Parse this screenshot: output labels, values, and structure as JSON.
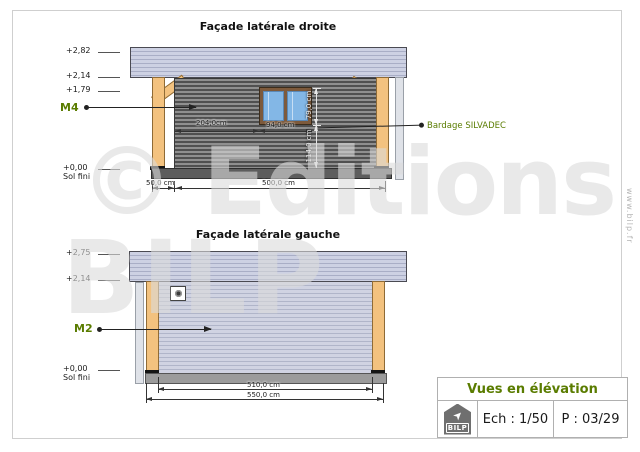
{
  "watermark": {
    "line1": "© Editions",
    "line2": "BILP",
    "side_text": "www.bilp.fr"
  },
  "facade_droite": {
    "title": "Façade latérale droite",
    "levels": {
      "l282": "+2,82",
      "l214": "+2,14",
      "l179": "+1,79",
      "l000": "+0,00",
      "sol": "Sol fini"
    },
    "marker": "M4",
    "cladding_note": "Bardage SILVADEC",
    "dims": {
      "post_offset": "50,0 cm",
      "wall_length": "500,0 cm",
      "window_offset": "204,0cm",
      "window_width": "94,0 cm",
      "window_height": "79,0 cm",
      "sill_height": "114,0 cm"
    }
  },
  "facade_gauche": {
    "title": "Façade latérale gauche",
    "levels": {
      "l275": "+2,75",
      "l214": "+2,14",
      "l000": "+0,00",
      "sol": "Sol fini"
    },
    "marker": "M2",
    "dims": {
      "inner": "510,0 cm",
      "outer": "550,0 cm"
    }
  },
  "title_block": {
    "title": "Vues en élévation",
    "scale": "Ech : 1/50",
    "page_num": "P : 03/29",
    "logo_text": "BILP"
  },
  "colors": {
    "accent_green": "#5a7c00",
    "wood": "#f3c27f",
    "roof": "#cdd1e3",
    "wall_dark": "#6f6f6f",
    "wall_light": "#c9cdde"
  }
}
